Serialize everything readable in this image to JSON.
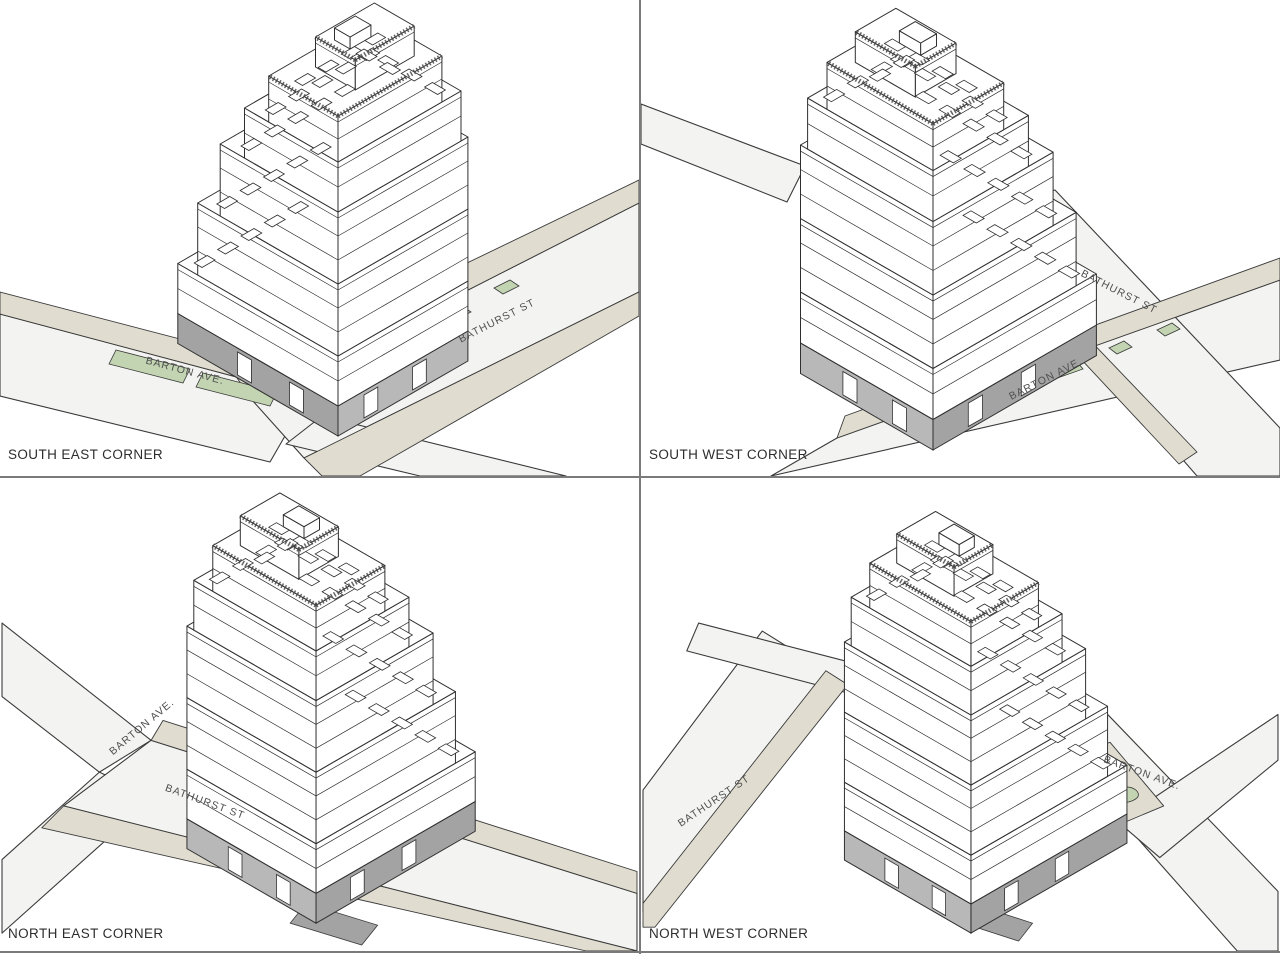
{
  "sheet": {
    "type": "axonometric-views",
    "building": "corner building at Bathurst St and Barton Ave"
  },
  "colors": {
    "background": "#ffffff",
    "road": "#f3f3f1",
    "sidewalk": "#e0ddd0",
    "green": "#c2d4b2",
    "line": "#3a3a3a",
    "building_line": "#2f2f2f",
    "face": "#ffffff",
    "storefront": "#a3a3a3",
    "storefront2": "#b8b8b8",
    "divider": "#7a7a7a"
  },
  "panels": [
    {
      "corner_label": "SOUTH EAST CORNER",
      "streets": [
        {
          "name": "BARTON AVE."
        },
        {
          "name": "BATHURST ST"
        }
      ]
    },
    {
      "corner_label": "SOUTH WEST CORNER",
      "streets": [
        {
          "name": "BATHURST ST"
        },
        {
          "name": "BARTON AVE."
        }
      ]
    },
    {
      "corner_label": "NORTH EAST CORNER",
      "streets": [
        {
          "name": "BARTON AVE."
        },
        {
          "name": "BATHURST ST"
        }
      ]
    },
    {
      "corner_label": "NORTH WEST CORNER",
      "streets": [
        {
          "name": "BATHURST ST"
        },
        {
          "name": "BARTON AVE."
        }
      ]
    }
  ]
}
